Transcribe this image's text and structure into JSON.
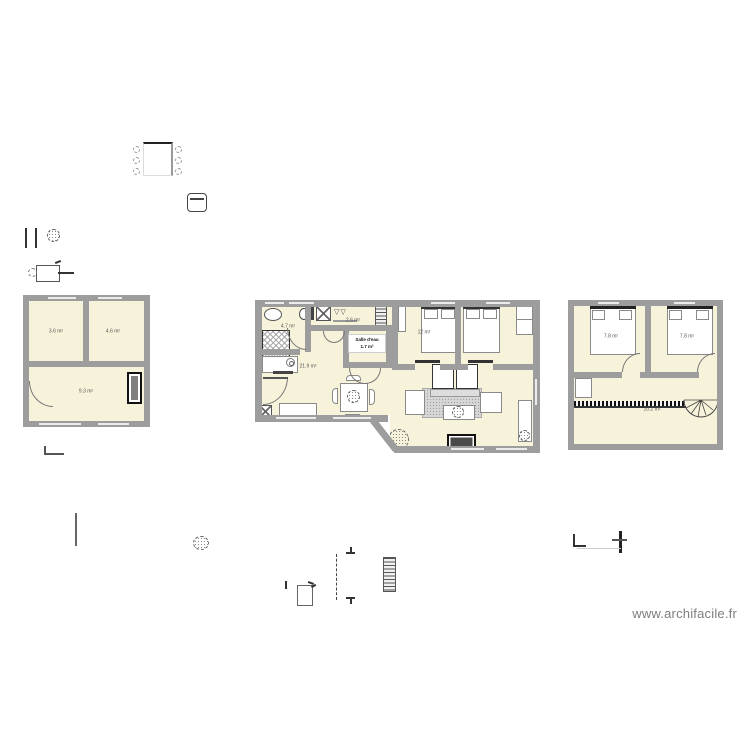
{
  "colors": {
    "wall": "#9d9d9d",
    "floor": "#f7f3da",
    "accent_dark": "#222222",
    "watermark_gray": "#7d7d7d"
  },
  "watermark": {
    "text": "www.archifacile.fr"
  },
  "plans": {
    "left": {
      "rooms": [
        {
          "area": "3.6 m²"
        },
        {
          "area": "4.6 m²"
        },
        {
          "area": "9.3 m²"
        }
      ]
    },
    "main": {
      "rooms": [
        {
          "area": "4.7 m²"
        },
        {
          "area": "2.6 m²"
        },
        {
          "name": "Salle d'eau",
          "area": "1.7 m²"
        },
        {
          "area": "21.9 m²"
        },
        {
          "area": "12 m²"
        }
      ]
    },
    "upper": {
      "rooms": [
        {
          "area": "7.8 m²"
        },
        {
          "area": "7.8 m²"
        },
        {
          "area": "10.2 m²"
        }
      ]
    }
  },
  "icons": {
    "sink_glyph": "▽▽"
  }
}
